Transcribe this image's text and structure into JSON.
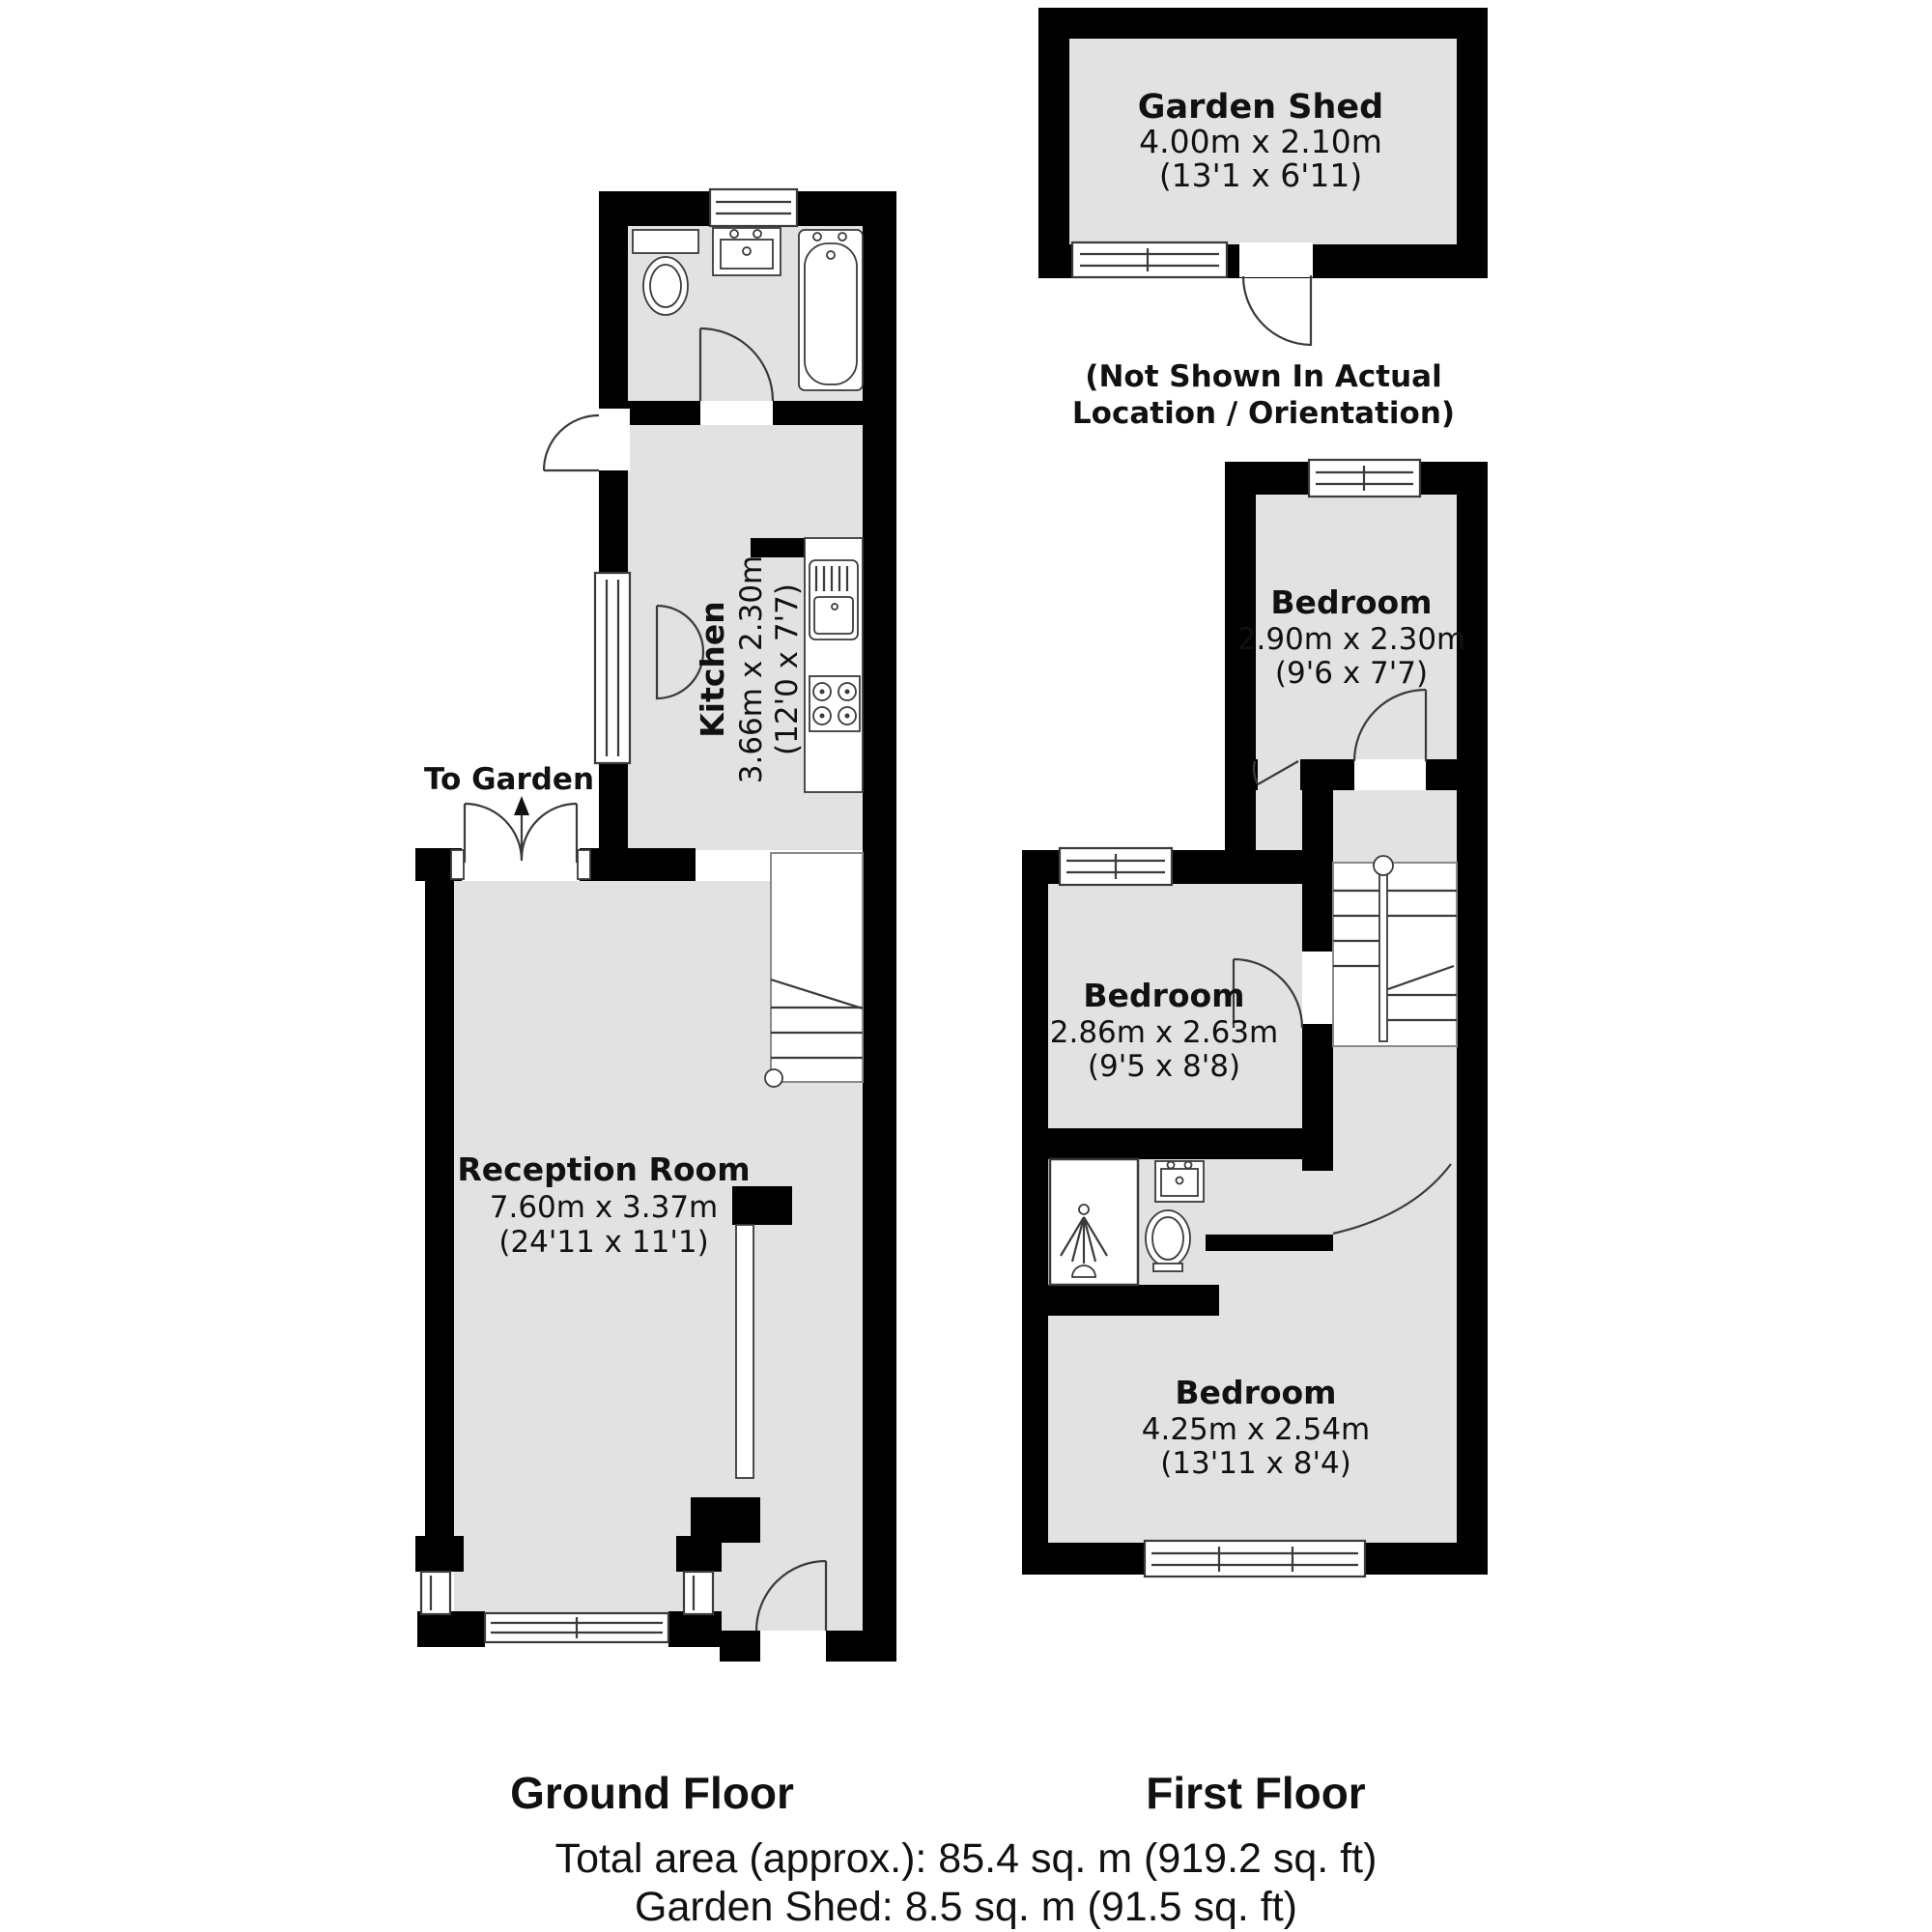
{
  "colors": {
    "wall": "#000000",
    "room_fill": "#e2e2e2",
    "detail_line": "#3a3a3a",
    "background": "#ffffff"
  },
  "garden_shed": {
    "name": "Garden Shed",
    "dims_metric": "4.00m x 2.10m",
    "dims_imperial": "(13'1 x 6'11)",
    "note_line1": "(Not Shown In Actual",
    "note_line2": "Location / Orientation)"
  },
  "ground_floor": {
    "label": "Ground Floor",
    "to_garden_label": "To Garden",
    "kitchen": {
      "name": "Kitchen",
      "dims_metric": "3.66m x 2.30m",
      "dims_imperial": "(12'0 x 7'7)"
    },
    "reception": {
      "name": "Reception Room",
      "dims_metric": "7.60m x 3.37m",
      "dims_imperial": "(24'11 x 11'1)"
    }
  },
  "first_floor": {
    "label": "First Floor",
    "bedroom_top": {
      "name": "Bedroom",
      "dims_metric": "2.90m x 2.30m",
      "dims_imperial": "(9'6 x 7'7)"
    },
    "bedroom_middle": {
      "name": "Bedroom",
      "dims_metric": "2.86m x 2.63m",
      "dims_imperial": "(9'5 x 8'8)"
    },
    "bedroom_bottom": {
      "name": "Bedroom",
      "dims_metric": "4.25m x 2.54m",
      "dims_imperial": "(13'11 x 8'4)"
    }
  },
  "summary": {
    "total_area": "Total area (approx.): 85.4 sq. m (919.2 sq. ft)",
    "shed_area": "Garden Shed: 8.5 sq. m (91.5 sq. ft)"
  }
}
